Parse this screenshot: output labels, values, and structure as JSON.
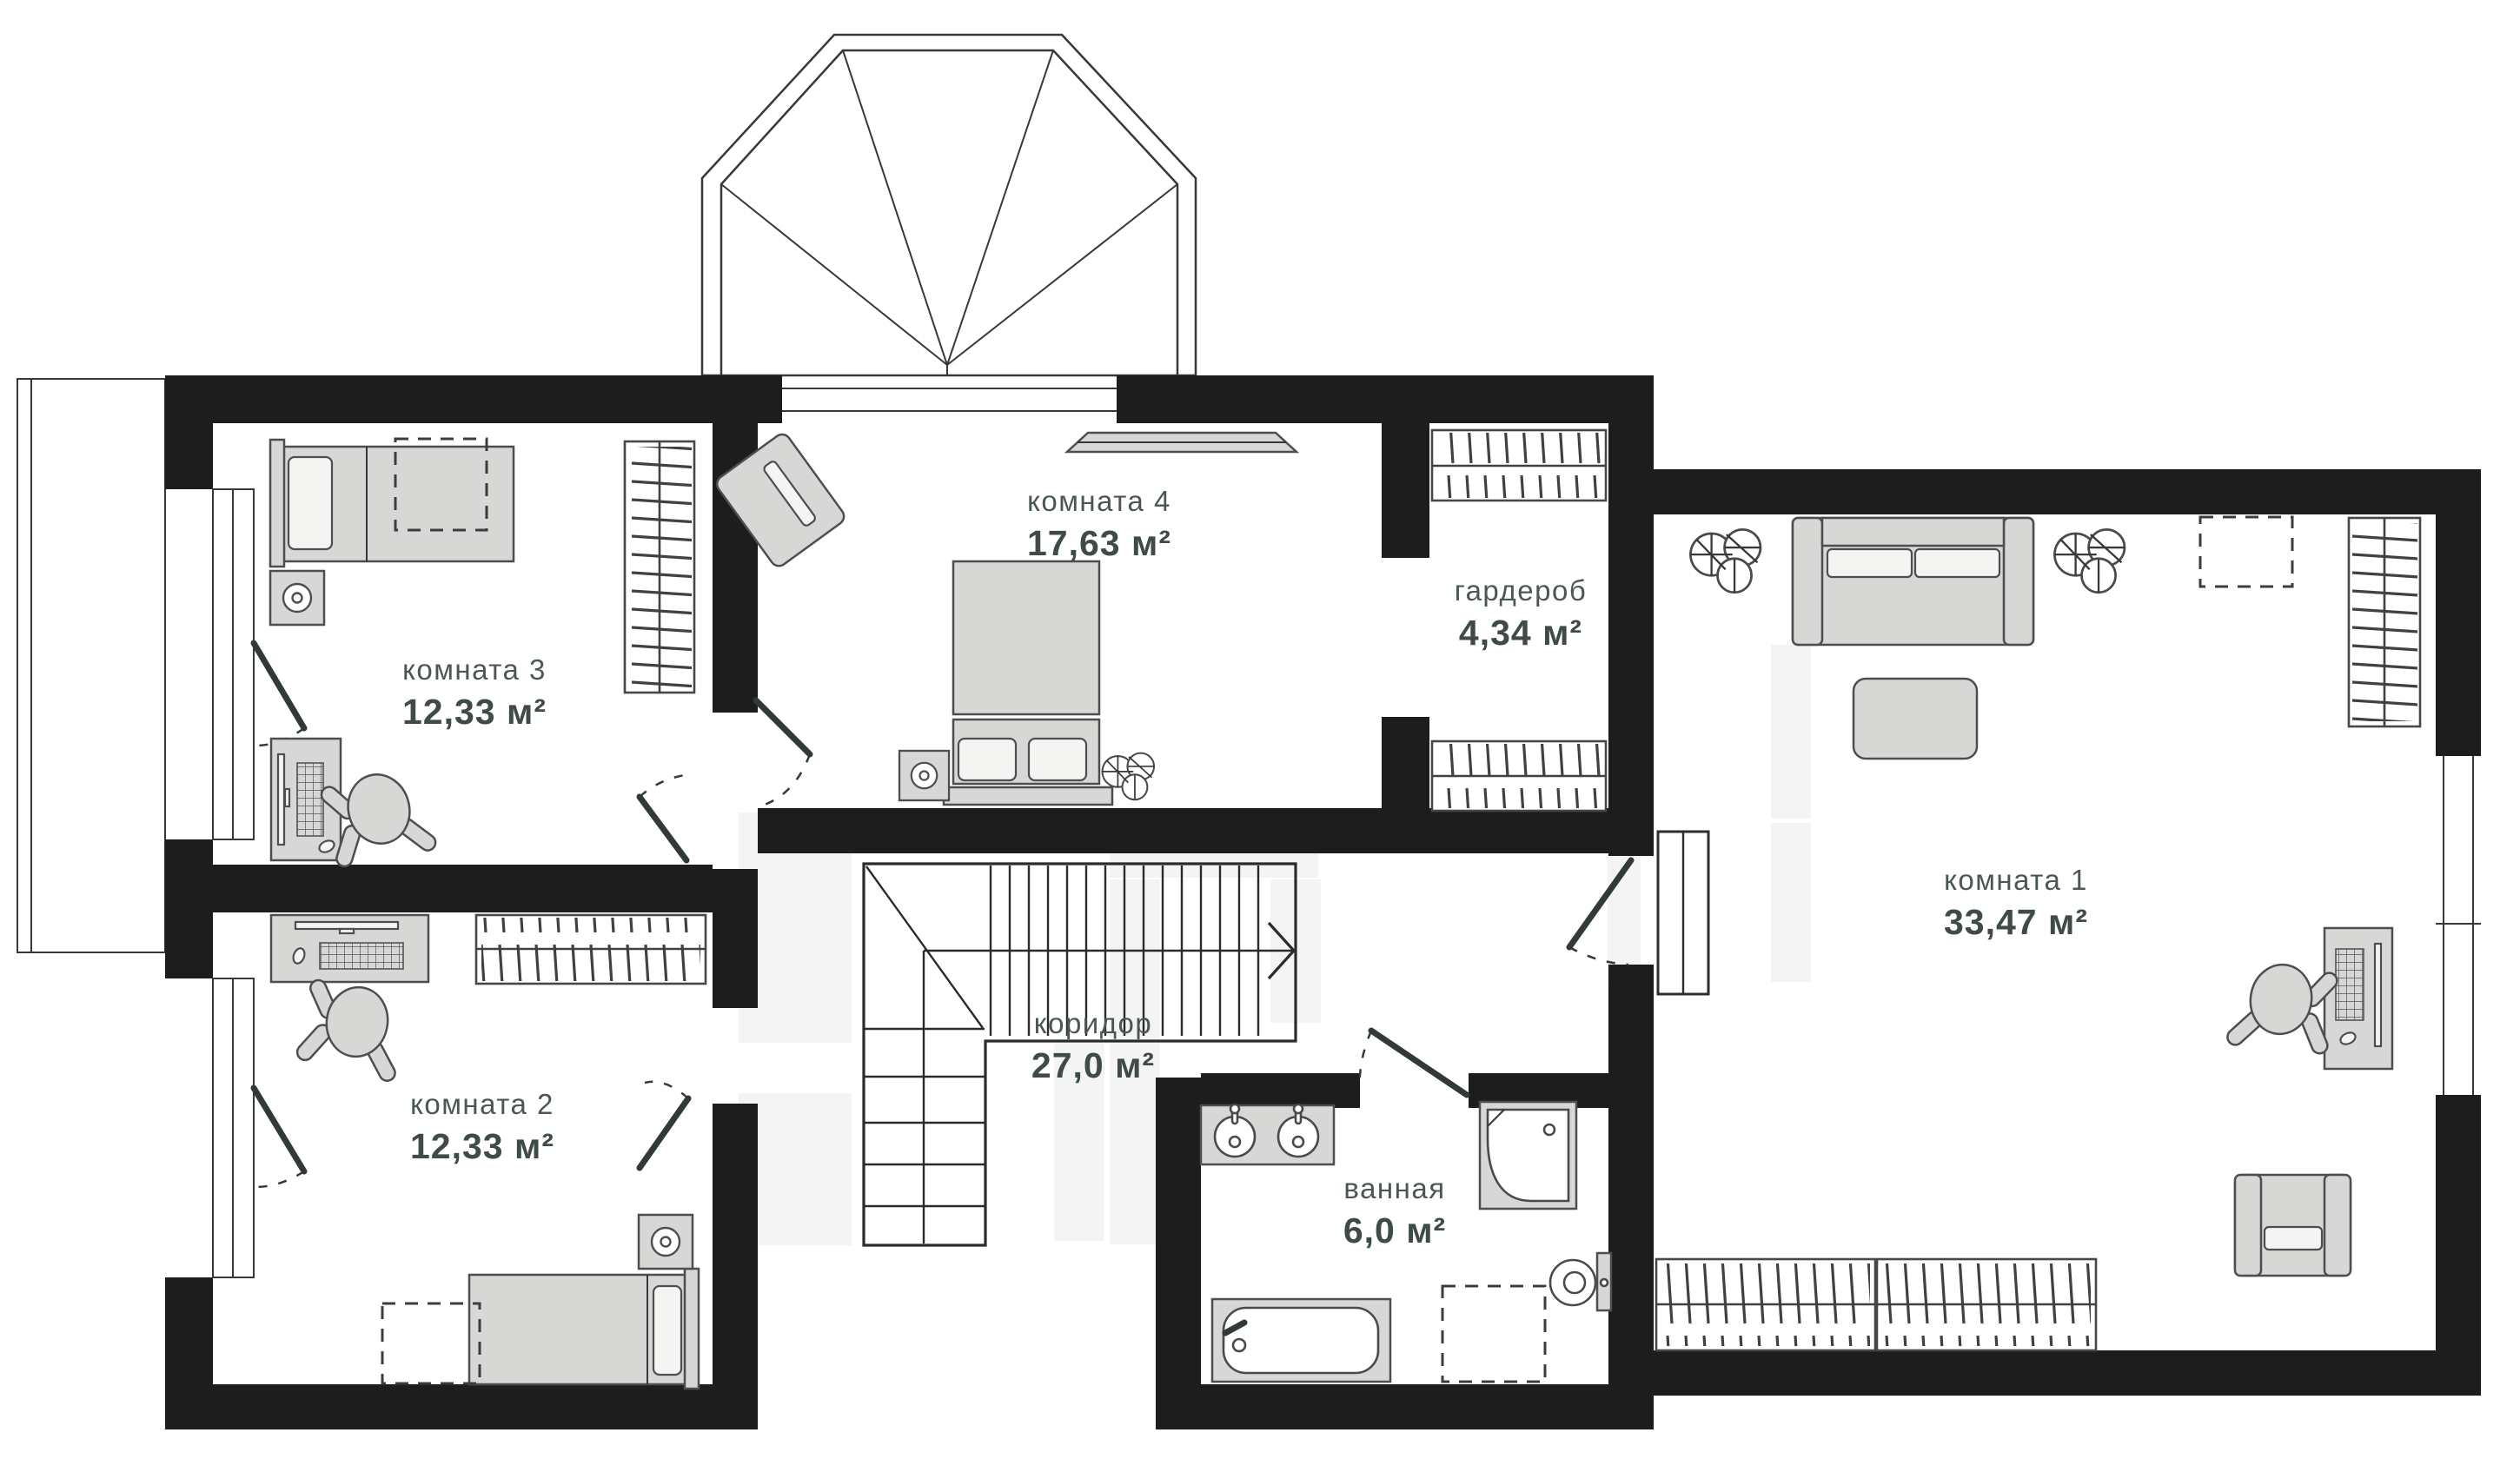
{
  "plan": {
    "type": "floor-plan",
    "language": "ru",
    "rooms": [
      {
        "name": "комната 4",
        "area": "17,63 м²"
      },
      {
        "name": "гардероб",
        "area": "4,34 м²"
      },
      {
        "name": "комната 3",
        "area": "12,33 м²"
      },
      {
        "name": "комната 2",
        "area": "12,33 м²"
      },
      {
        "name": "комната 1",
        "area": "33,47 м²"
      },
      {
        "name": "коридор",
        "area": "27,0 м²"
      },
      {
        "name": "ванная",
        "area": "6,0 м²"
      }
    ],
    "colors": {
      "wall": "#1d1d1d",
      "furniture_fill": "#d7d7d6",
      "furniture_stroke": "#4e4e4e",
      "light_fill": "#f4f4f3",
      "line": "#35393b",
      "label_name": "#4b5852",
      "label_area": "#3f4b46",
      "watermark": "#f4f4f4",
      "bg": "#ffffff"
    },
    "icons": [
      "bay-window",
      "balcony",
      "stairs-icon",
      "door-swing-icon",
      "double-bed-icon",
      "single-bed-icon",
      "nightstand-lamp-icon",
      "wardrobe-rail-icon",
      "desk-icon",
      "office-chair-icon",
      "armchair-icon",
      "sofa-icon",
      "coffee-table-icon",
      "plant-icon",
      "double-sink-icon",
      "shower-icon",
      "toilet-icon",
      "bathtub-icon",
      "appliance-placeholder-dashed",
      "window-icon",
      "wall-niche-icon",
      "shelf-icon"
    ]
  }
}
